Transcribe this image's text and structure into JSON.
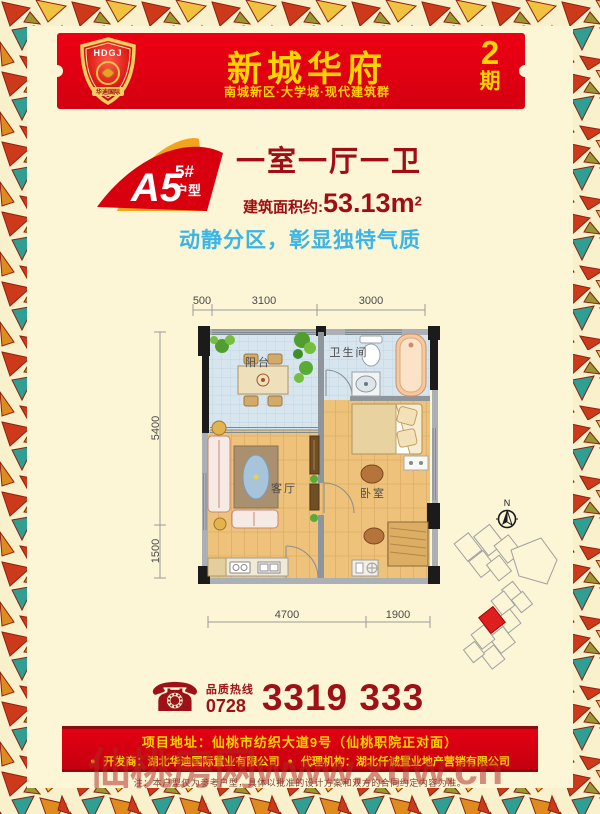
{
  "header": {
    "logo_acronym": "HDGJ",
    "logo_name": "华迪国际",
    "title": "新城华府",
    "subtitle": "南城新区·大学城·现代建筑群",
    "phase_number": "2",
    "phase_label": "期"
  },
  "unit": {
    "code": "A5",
    "building": "5#",
    "type_label": "户型",
    "rooms_headline": "一室一厅一卫",
    "area_label": "建筑面积约:",
    "area_value": "53.13m",
    "area_sup": "2",
    "slogan": "动静分区，彰显独特气质"
  },
  "floorplan": {
    "dims": {
      "top": [
        "500",
        "3100",
        "3000"
      ],
      "left": [
        "5400",
        "1500"
      ],
      "bottom": [
        "4700",
        "1900"
      ]
    },
    "rooms": {
      "balcony": "阳台",
      "bathroom": "卫生间",
      "living": "客厅",
      "bedroom": "卧室"
    },
    "compass_n": "N"
  },
  "contact": {
    "phone_icon": "☎",
    "hotline_label": "品质热线",
    "area_code": "0728",
    "number": "3319 333"
  },
  "footer": {
    "address": "项目地址：仙桃市纺织大道9号（仙桃职院正对面）",
    "bullet": "●",
    "developer": "开发商：湖北华迪国际置业有限公司",
    "agency": "代理机构：湖北仟诚置业地产营销有限公司",
    "disclaimer": "注：本户型仅为参考户型，具体以批准的设计方案和双方的合同约定内容为准。"
  },
  "watermark": {
    "text": "仙桃房网www.xtfw.cn"
  },
  "colors": {
    "banner_red": "#d40012",
    "gold": "#ffd400",
    "dark_red": "#9d0a12",
    "cyan": "#3ab5e7",
    "cream": "#fcf5d6",
    "unit_highlight": "#dd1f1f"
  }
}
